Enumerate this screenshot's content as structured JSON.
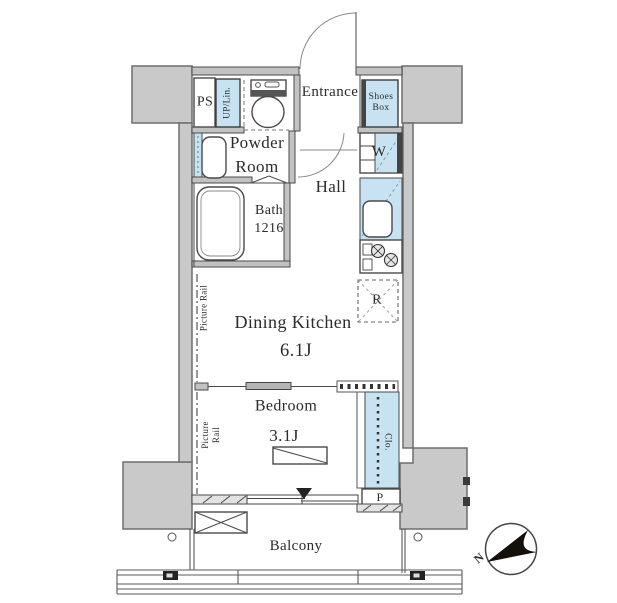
{
  "colors": {
    "accent_blue": "#c7e3f1",
    "pillar_gray": "#c9c9c9",
    "pillar_edge": "#6e6e6e",
    "wall_fill": "#c2c2c2",
    "line": "#4a4a4a",
    "blue_dash": "#6fa0b8",
    "ink": "#2b2b2b"
  },
  "labels": {
    "ps": "PS",
    "up_lin": "UP/Lin.",
    "entrance": "Entrance",
    "shoes_line1": "Shoes",
    "shoes_line2": "Box",
    "powder_line1": "Powder",
    "powder_line2": "Room",
    "hall": "Hall",
    "washer": "W",
    "bath_name": "Bath",
    "bath_size": "1216",
    "dining_kitchen": "Dining Kitchen",
    "dining_kitchen_size": "6.1J",
    "fridge": "R",
    "picture_rail_dk": "Picture Rail",
    "picture_rail_bed_line1": "Picture",
    "picture_rail_bed_line2": "Rail",
    "bedroom": "Bedroom",
    "bedroom_size": "3.1J",
    "closet": "Clo.",
    "porch": "P",
    "balcony": "Balcony",
    "north": "N"
  }
}
